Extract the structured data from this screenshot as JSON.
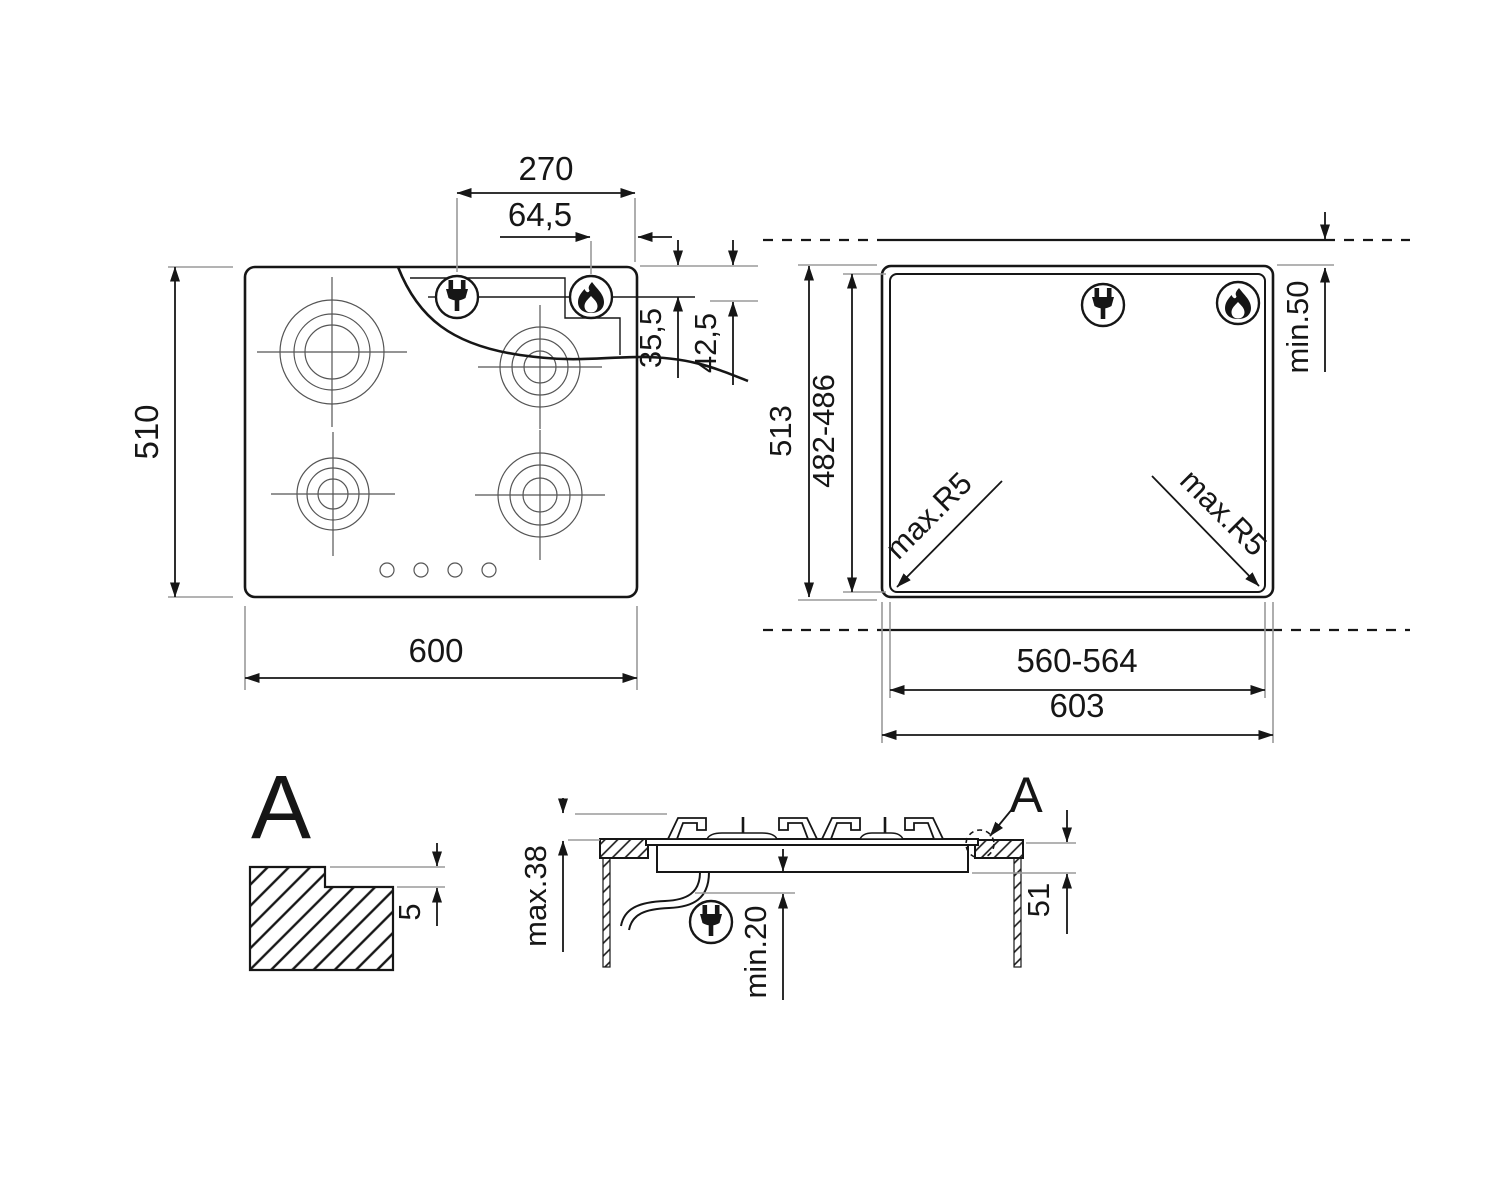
{
  "top_view": {
    "width": "600",
    "height": "510",
    "plug_offset": "270",
    "gas_offset": "64,5",
    "elec_depth": "35,5",
    "gas_depth": "42,5"
  },
  "cutout_view": {
    "overall_height": "513",
    "cutout_depth": "482-486",
    "min_wall_clearance": "min.50",
    "corner_radius_left": "max.R5",
    "corner_radius_right": "max.R5",
    "cutout_width": "560-564",
    "overall_width": "603"
  },
  "detail_view": {
    "label": "A",
    "step_depth": "5"
  },
  "section_view": {
    "detail_label": "A",
    "max_height": "max.38",
    "min_clearance": "min.20",
    "recess_depth": "51"
  },
  "icons": {
    "plug": "power-plug",
    "flame": "gas-flame"
  },
  "colors": {
    "line": "#161616",
    "extension": "#9a9a9a",
    "background": "#ffffff"
  }
}
